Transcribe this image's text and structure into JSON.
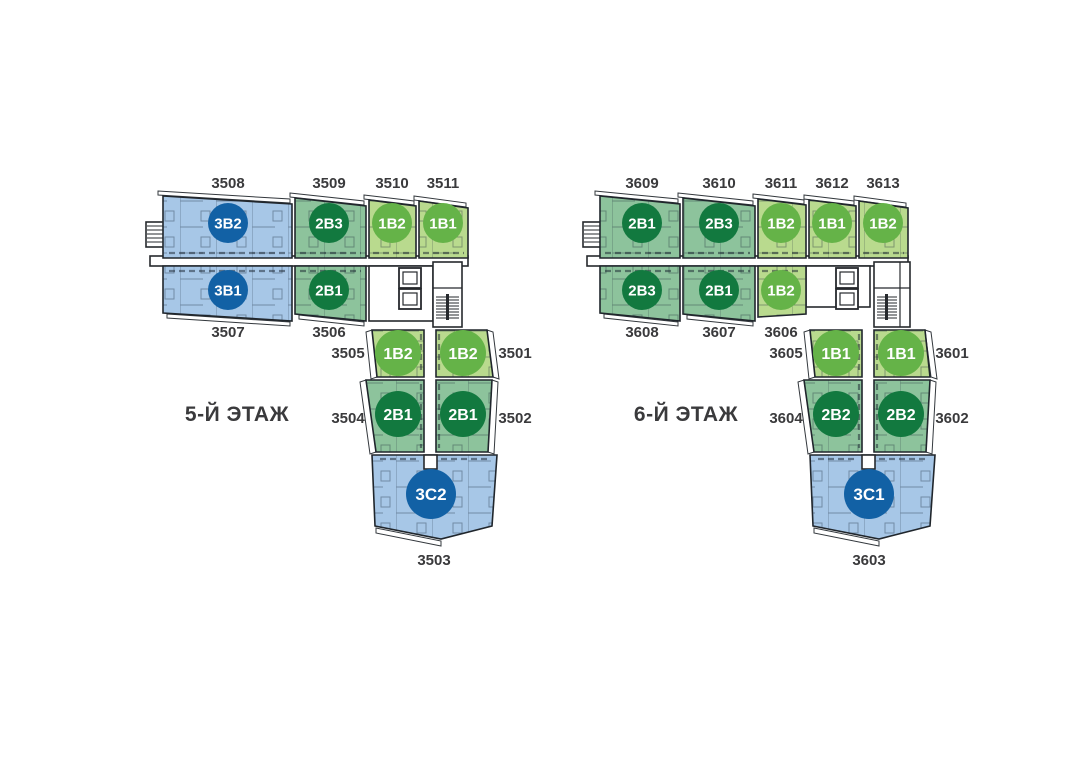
{
  "page": {
    "background": "#ffffff"
  },
  "colors": {
    "apt_blue": "#a7c7e7",
    "apt_green": "#8dc39c",
    "apt_lgreen": "#b9da8e",
    "badge_blue": "#1261a5",
    "badge_green": "#12793f",
    "badge_lgreen": "#65b348"
  },
  "floors": [
    {
      "name": "5-Й ЭТАЖ",
      "units": [
        {
          "number": "3508",
          "type": "3B2"
        },
        {
          "number": "3509",
          "type": "2B3"
        },
        {
          "number": "3510",
          "type": "1B2"
        },
        {
          "number": "3511",
          "type": "1B1"
        },
        {
          "number": "3507",
          "type": "3B1"
        },
        {
          "number": "3506",
          "type": "2B1"
        },
        {
          "number": "3505",
          "type": "1B2"
        },
        {
          "number": "3501",
          "type": "1B2"
        },
        {
          "number": "3504",
          "type": "2B1"
        },
        {
          "number": "3502",
          "type": "2B1"
        },
        {
          "number": "3503",
          "type": "3C2"
        }
      ]
    },
    {
      "name": "6-Й ЭТАЖ",
      "units": [
        {
          "number": "3609",
          "type": "2B1"
        },
        {
          "number": "3610",
          "type": "2B3"
        },
        {
          "number": "3611",
          "type": "1B2"
        },
        {
          "number": "3612",
          "type": "1B1"
        },
        {
          "number": "3613",
          "type": "1B2"
        },
        {
          "number": "3608",
          "type": "2B3"
        },
        {
          "number": "3607",
          "type": "2B1"
        },
        {
          "number": "3606",
          "type": "1B2"
        },
        {
          "number": "3605",
          "type": "1B1"
        },
        {
          "number": "3601",
          "type": "1B1"
        },
        {
          "number": "3604",
          "type": "2B2"
        },
        {
          "number": "3602",
          "type": "2B2"
        },
        {
          "number": "3603",
          "type": "3C1"
        }
      ]
    }
  ]
}
